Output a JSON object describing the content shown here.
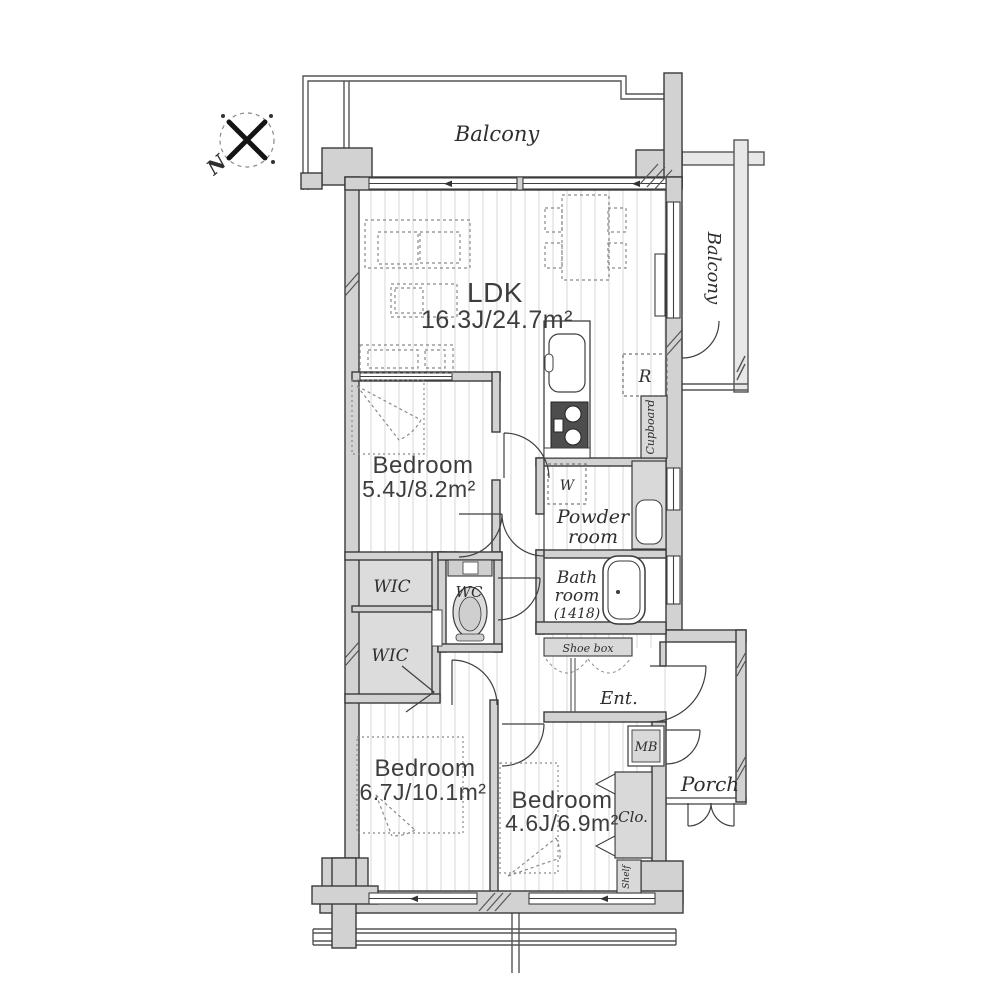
{
  "labels": {
    "compass_n": "N",
    "balcony_top": "Balcony",
    "balcony_right": "Balcony",
    "ldk_name": "LDK",
    "ldk_size": "16.3J/24.7m²",
    "bed1_name": "Bedroom",
    "bed1_size": "5.4J/8.2m²",
    "bed2_name": "Bedroom",
    "bed2_size": "6.7J/10.1m²",
    "bed3_name": "Bedroom",
    "bed3_size": "4.6J/6.9m²",
    "powder_1": "Powder",
    "powder_2": "room",
    "bath_1": "Bath",
    "bath_2": "room",
    "bath_3": "(1418)",
    "wic_upper": "WIC",
    "wic_lower": "WIC",
    "wc": "WC",
    "ent": "Ent.",
    "shoe_box": "Shoe box",
    "mb": "MB",
    "porch": "Porch",
    "clo": "Clo.",
    "shelf": "Shelf",
    "cupboard": "Cupboard",
    "fridge": "R",
    "washer": "W"
  },
  "colors": {
    "wall": "#d2d2d2",
    "wall_line": "#3a3a3a",
    "closet_fill": "#dcdcdc",
    "floor_stripe": "#ebebeb",
    "dash": "#8a8a8a"
  }
}
